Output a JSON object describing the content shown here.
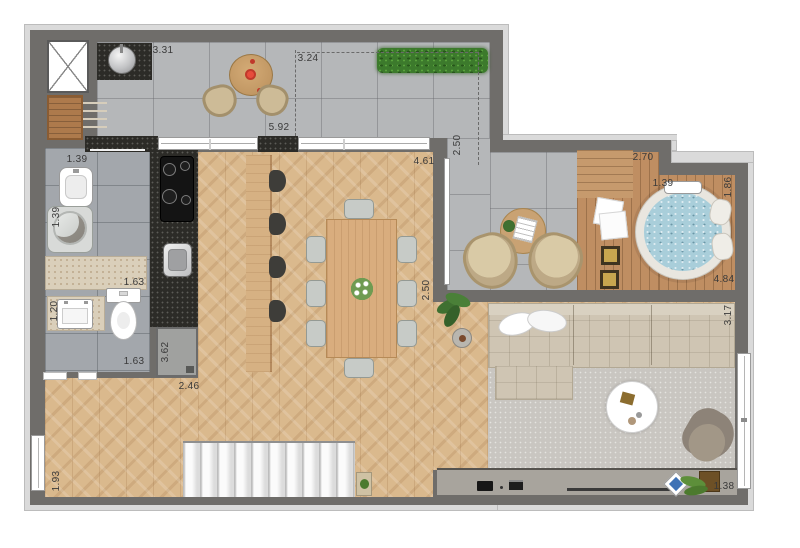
{
  "plan": {
    "type": "residential-floor-plan"
  },
  "dimensions": {
    "terrace_counter": "3.31",
    "terrace_depth": "3.24",
    "terrace_width": "5.92",
    "terrace_right": "2.50",
    "dining_door": "4.61",
    "deck_top": "2.70",
    "spa_width": "1.39",
    "spa_side": "1.86",
    "deck_bottom": "4.84",
    "dining_right": "2.50",
    "laundry_top": "1.39",
    "laundry_side": "1.39",
    "bath_counter": "1.63",
    "vanity_width": "1.20",
    "bath_width": "1.63",
    "fridge_side": "3.62",
    "hall_width": "2.46",
    "stair_window": "1.93",
    "living_side": "3.17",
    "balcony_edge": "1.38"
  },
  "palette": {
    "wall": "#6f6d6a",
    "molding": "#dadada",
    "terrace_tile": "#b5b7b9",
    "bath_tile": "#a3a7ac",
    "wood_floor": "#dab98d",
    "deck_wood": "#bf8e62",
    "granite": "#2c2b27",
    "marble": "#dacfba",
    "spa_water": "#a9ceda",
    "sofa": "#cfc5b3",
    "rug": "#c9c6c1",
    "hedge_green": "#3c7a2c",
    "accent_red": "#c0392b"
  }
}
